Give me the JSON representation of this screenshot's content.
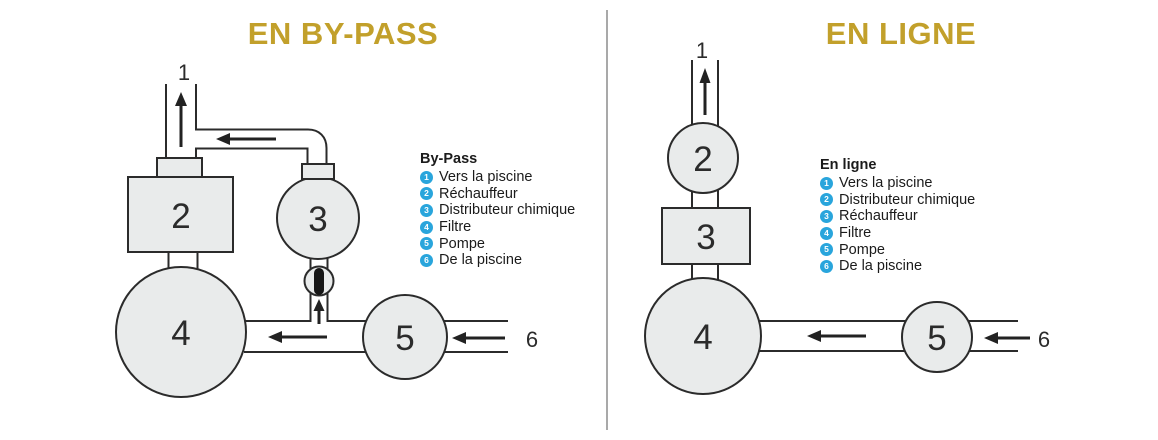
{
  "left_panel": {
    "title": "EN BY-PASS",
    "legend_title": "By-Pass",
    "legend": [
      {
        "num": "1",
        "label": "Vers la piscine"
      },
      {
        "num": "2",
        "label": "Réchauffeur"
      },
      {
        "num": "3",
        "label": "Distributeur chimique"
      },
      {
        "num": "4",
        "label": "Filtre"
      },
      {
        "num": "5",
        "label": "Pompe"
      },
      {
        "num": "6",
        "label": "De la piscine"
      }
    ],
    "nodes": {
      "to_pool": "1",
      "heater": "2",
      "chem_dispenser": "3",
      "filter": "4",
      "pump": "5",
      "from_pool": "6"
    }
  },
  "right_panel": {
    "title": "EN LIGNE",
    "legend_title": "En ligne",
    "legend": [
      {
        "num": "1",
        "label": "Vers la piscine"
      },
      {
        "num": "2",
        "label": "Distributeur chimique"
      },
      {
        "num": "3",
        "label": "Réchauffeur"
      },
      {
        "num": "4",
        "label": "Filtre"
      },
      {
        "num": "5",
        "label": "Pompe"
      },
      {
        "num": "6",
        "label": "De la piscine"
      }
    ],
    "nodes": {
      "to_pool": "1",
      "chem_dispenser": "2",
      "heater": "3",
      "filter": "4",
      "pump": "5",
      "from_pool": "6"
    }
  },
  "colors": {
    "accent_gold": "#c2a02b",
    "badge_blue": "#29a5dc",
    "shape_fill": "#e9ebeb",
    "outline": "#2b2b2b",
    "divider_gray": "#a9a9a9"
  }
}
